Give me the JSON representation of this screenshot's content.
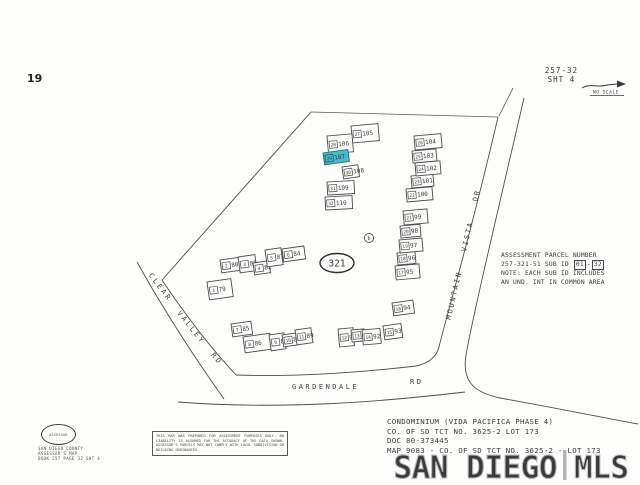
{
  "header": {
    "page_number": "19",
    "sheet_ref_line1": "257-32",
    "sheet_ref_line2": "SHT 4",
    "no_scale_label": "NO SCALE"
  },
  "map": {
    "parcel_label": "321",
    "block_letter": "b",
    "highlight_color": "#4fb9c9",
    "streets": {
      "clear_valley": "CLEAR VALLEY RD",
      "gardendale": "GARDENDALE",
      "gardendale_suffix": "RD",
      "mountain_vista": "MOUNTAIN VISTA DR"
    },
    "buildings": [
      {
        "unit": "79",
        "sub": "1",
        "x": 207,
        "y": 282,
        "w": 24,
        "h": 18,
        "rot": -8,
        "hl": false
      },
      {
        "unit": "80",
        "sub": "2",
        "x": 220,
        "y": 260,
        "w": 21,
        "h": 13,
        "rot": -8,
        "hl": false
      },
      {
        "unit": "81",
        "sub": "3",
        "x": 238,
        "y": 257,
        "w": 17,
        "h": 16,
        "rot": -8,
        "hl": false
      },
      {
        "unit": "82",
        "sub": "4",
        "x": 253,
        "y": 263,
        "w": 16,
        "h": 12,
        "rot": -8,
        "hl": false
      },
      {
        "unit": "83",
        "sub": "5",
        "x": 265,
        "y": 250,
        "w": 16,
        "h": 17,
        "rot": -8,
        "hl": false
      },
      {
        "unit": "84",
        "sub": "6",
        "x": 282,
        "y": 249,
        "w": 22,
        "h": 13,
        "rot": -8,
        "hl": false
      },
      {
        "unit": "85",
        "sub": "7",
        "x": 231,
        "y": 324,
        "w": 20,
        "h": 13,
        "rot": -8,
        "hl": false
      },
      {
        "unit": "86",
        "sub": "8",
        "x": 243,
        "y": 337,
        "w": 27,
        "h": 16,
        "rot": -8,
        "hl": false
      },
      {
        "unit": "87",
        "sub": "9",
        "x": 269,
        "y": 335,
        "w": 15,
        "h": 16,
        "rot": -8,
        "hl": false
      },
      {
        "unit": "88",
        "sub": "10",
        "x": 282,
        "y": 335,
        "w": 15,
        "h": 12,
        "rot": -8,
        "hl": false
      },
      {
        "unit": "89",
        "sub": "11",
        "x": 295,
        "y": 330,
        "w": 16,
        "h": 15,
        "rot": -8,
        "hl": false
      },
      {
        "unit": "90",
        "sub": "12",
        "x": 338,
        "y": 329,
        "w": 15,
        "h": 18,
        "rot": -5,
        "hl": false
      },
      {
        "unit": "91",
        "sub": "13",
        "x": 351,
        "y": 330,
        "w": 13,
        "h": 12,
        "rot": -5,
        "hl": false
      },
      {
        "unit": "92",
        "sub": "14",
        "x": 362,
        "y": 330,
        "w": 18,
        "h": 15,
        "rot": -5,
        "hl": false
      },
      {
        "unit": "93",
        "sub": "15",
        "x": 383,
        "y": 326,
        "w": 18,
        "h": 14,
        "rot": -8,
        "hl": false
      },
      {
        "unit": "94",
        "sub": "16",
        "x": 392,
        "y": 303,
        "w": 21,
        "h": 13,
        "rot": -8,
        "hl": false
      },
      {
        "unit": "95",
        "sub": "17",
        "x": 395,
        "y": 266,
        "w": 24,
        "h": 14,
        "rot": -5,
        "hl": false
      },
      {
        "unit": "96",
        "sub": "18",
        "x": 397,
        "y": 253,
        "w": 18,
        "h": 12,
        "rot": -5,
        "hl": false
      },
      {
        "unit": "97",
        "sub": "19",
        "x": 399,
        "y": 240,
        "w": 23,
        "h": 13,
        "rot": -5,
        "hl": false
      },
      {
        "unit": "98",
        "sub": "20",
        "x": 400,
        "y": 226,
        "w": 20,
        "h": 12,
        "rot": -5,
        "hl": false
      },
      {
        "unit": "99",
        "sub": "21",
        "x": 403,
        "y": 211,
        "w": 24,
        "h": 14,
        "rot": -5,
        "hl": false
      },
      {
        "unit": "100",
        "sub": "22",
        "x": 406,
        "y": 189,
        "w": 26,
        "h": 13,
        "rot": -5,
        "hl": false
      },
      {
        "unit": "101",
        "sub": "23",
        "x": 411,
        "y": 176,
        "w": 22,
        "h": 12,
        "rot": -5,
        "hl": false
      },
      {
        "unit": "102",
        "sub": "24",
        "x": 415,
        "y": 163,
        "w": 25,
        "h": 13,
        "rot": -5,
        "hl": false
      },
      {
        "unit": "103",
        "sub": "25",
        "x": 412,
        "y": 151,
        "w": 24,
        "h": 12,
        "rot": -5,
        "hl": false
      },
      {
        "unit": "104",
        "sub": "26",
        "x": 414,
        "y": 136,
        "w": 27,
        "h": 14,
        "rot": -5,
        "hl": false
      },
      {
        "unit": "105",
        "sub": "27",
        "x": 351,
        "y": 126,
        "w": 27,
        "h": 17,
        "rot": -5,
        "hl": false
      },
      {
        "unit": "106",
        "sub": "28",
        "x": 327,
        "y": 136,
        "w": 25,
        "h": 18,
        "rot": -5,
        "hl": false
      },
      {
        "unit": "107",
        "sub": "29",
        "x": 323,
        "y": 153,
        "w": 25,
        "h": 12,
        "rot": -8,
        "hl": true
      },
      {
        "unit": "108",
        "sub": "30",
        "x": 342,
        "y": 167,
        "w": 16,
        "h": 12,
        "rot": -8,
        "hl": false
      },
      {
        "unit": "109",
        "sub": "31",
        "x": 327,
        "y": 182,
        "w": 27,
        "h": 13,
        "rot": -3,
        "hl": false
      },
      {
        "unit": "110",
        "sub": "32",
        "x": 325,
        "y": 197,
        "w": 27,
        "h": 13,
        "rot": -3,
        "hl": false
      }
    ]
  },
  "assessment_note": {
    "line1": "ASSESSMENT PARCEL NUMBER",
    "line2_prefix": "257-321-51 SUB ID",
    "sub_from": "01",
    "sub_sep": "-",
    "sub_to": "32",
    "line3": "NOTE: EACH SUB ID INCLUDES",
    "line4": "AN UND. INT IN COMMON AREA"
  },
  "footer": {
    "seal_text": "ASSESSOR",
    "county_lines": [
      "SAN DIEGO COUNTY",
      "ASSESSOR'S MAP",
      "BOOK 257 PAGE 32 SHT 4"
    ],
    "disclaimer": "THIS MAP WAS PREPARED FOR ASSESSMENT PURPOSES ONLY. NO LIABILITY IS ASSUMED FOR THE ACCURACY OF THE DATA SHOWN. ASSESSOR'S PARCELS MAY NOT COMPLY WITH LOCAL SUBDIVISION OR BUILDING ORDINANCES.",
    "condo_lines": [
      "CONDOMINIUM (VIDA PACIFICA PHASE 4)",
      "CO. OF SD TCT NO. 3625-2  LOT 173",
      "DOC 80-373445",
      "MAP 9083 - CO. OF SD TCT NO. 3625-2 - LOT 173"
    ]
  },
  "watermark": {
    "left": "SAN DIEGO",
    "divider": "|",
    "right": "MLS"
  }
}
